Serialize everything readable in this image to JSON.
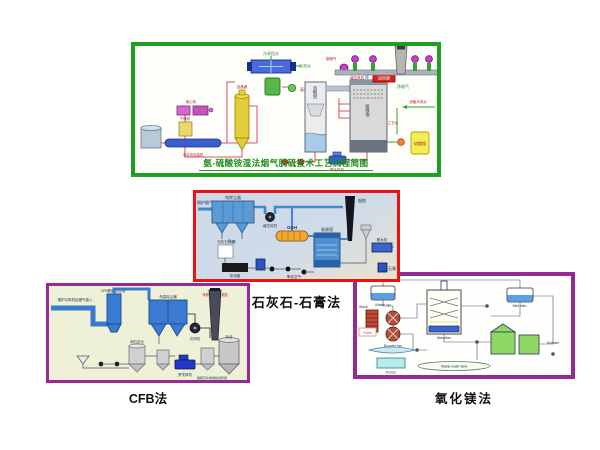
{
  "page": {
    "background": "#ffffff"
  },
  "panels": {
    "ammonia": {
      "border_color": "#1f9e1f",
      "title": "氨-硫酸铵湿法烟气脱硫技术工艺流程简图",
      "labels": {
        "cooling_return": "冷却回水",
        "cooling_water": "冷却水",
        "vacuum_pump": "真空泵",
        "crystallizer": "结晶器",
        "dryer": "干燥机",
        "centrifuge": "离心机",
        "packer": "半自动包装机",
        "raw_gas": "原烟气",
        "booster_fan": "增压风机",
        "heater": "加热器",
        "clean_gas": "净烟气",
        "concentrator": "浓缩塔",
        "absorber": "吸收塔",
        "oxidation_fan": "氧化风机",
        "process_water": "工艺水",
        "flush_water": "设备冲洗水",
        "ammonium_sulfate": "硫酸铵"
      }
    },
    "limestone": {
      "caption": "石灰石-石膏法",
      "border_color": "#ee1111",
      "labels": {
        "boiler_gas": "锅炉烟气",
        "esp": "电除尘器",
        "fly_ash": "飞灰",
        "booster_fan": "增压风机",
        "ggh": "GGH",
        "absorber": "吸收塔",
        "stack": "烟囱",
        "limestone_silo": "石灰石粉仓",
        "slurry_tank": "浆液箱",
        "oxidation_air": "氧化空气",
        "dewater": "脱水机",
        "gypsum": "石膏"
      }
    },
    "cfb": {
      "caption": "CFB法",
      "border_color": "#952a95",
      "labels": {
        "inlet": "锅炉引风机后烟气接入",
        "outlet": "净烟气并入原烟道",
        "reactor": "CFB脱硫反应塔",
        "bag_filter": "布袋除尘器",
        "id_fan": "引风机",
        "lime_silo": "消石灰仓",
        "roots_blower": "罗茨风机",
        "ash_silo": "灰仓",
        "ash_out": "脱硫灰外排或综合利用"
      }
    },
    "mgo": {
      "caption": "氧化镁法",
      "border_color": "#952a95",
      "labels": {
        "makeup": "Make up",
        "stack": "Stack",
        "fuels": "Fuels",
        "booster_fan": "Booster fan",
        "absorber": "Absorber",
        "mist": "Mist elim.",
        "oxidizer": "Oxidizer",
        "ponds": "Ponds",
        "waste_water": "Waste water tank"
      }
    }
  }
}
